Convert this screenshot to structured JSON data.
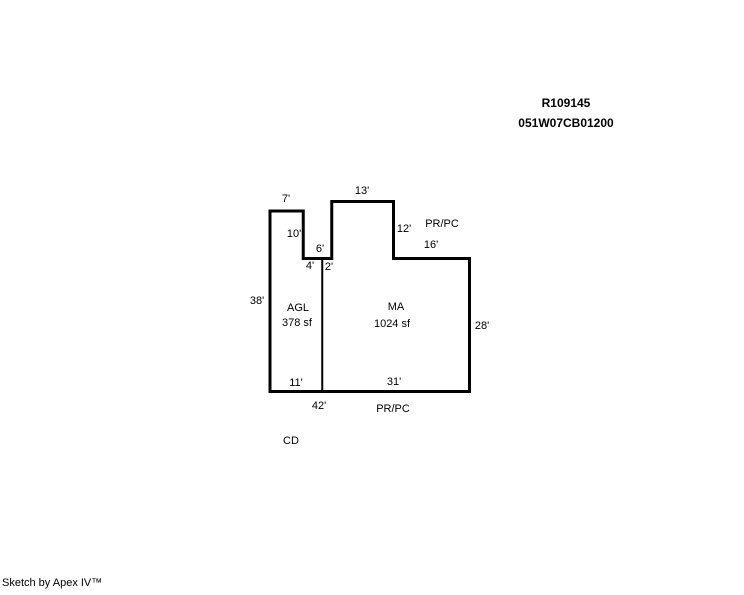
{
  "page": {
    "background": "#ffffff",
    "text_color": "#000000"
  },
  "header": {
    "account_id": "R109145",
    "map_taxlot": "051W07CB01200"
  },
  "sketch": {
    "line_color": "#000000",
    "outline_stroke_px": 3,
    "divider_stroke_px": 2,
    "px_per_ft": 4.75,
    "origin_px": {
      "x": 270,
      "y": 211
    },
    "outline_ft": [
      [
        0,
        0
      ],
      [
        7,
        0
      ],
      [
        7,
        10
      ],
      [
        13,
        10
      ],
      [
        13,
        -2
      ],
      [
        26,
        -2
      ],
      [
        26,
        10
      ],
      [
        42,
        10
      ],
      [
        42,
        38
      ],
      [
        0,
        38
      ]
    ],
    "divider_ft": [
      [
        11,
        10
      ],
      [
        11,
        38
      ]
    ],
    "areas": [
      {
        "code": "AGL",
        "size": "378 sf"
      },
      {
        "code": "MA",
        "size": "1024 sf"
      }
    ],
    "labels": [
      {
        "text": "7'",
        "kind": "dimension",
        "x": 286,
        "y": 199
      },
      {
        "text": "13'",
        "kind": "dimension",
        "x": 362,
        "y": 191
      },
      {
        "text": "10'",
        "kind": "dimension",
        "x": 294,
        "y": 234
      },
      {
        "text": "6'",
        "kind": "dimension",
        "x": 320,
        "y": 249
      },
      {
        "text": "4'",
        "kind": "dimension",
        "x": 310,
        "y": 266
      },
      {
        "text": "2'",
        "kind": "dimension",
        "x": 329,
        "y": 267
      },
      {
        "text": "12'",
        "kind": "dimension",
        "x": 404,
        "y": 229
      },
      {
        "text": "PR/PC",
        "kind": "annotation",
        "x": 442,
        "y": 224
      },
      {
        "text": "16'",
        "kind": "dimension",
        "x": 431,
        "y": 245
      },
      {
        "text": "38'",
        "kind": "dimension",
        "x": 257,
        "y": 301
      },
      {
        "text": "AGL",
        "kind": "area-code",
        "x": 298,
        "y": 308
      },
      {
        "text": "378 sf",
        "kind": "area-size",
        "x": 297,
        "y": 323
      },
      {
        "text": "MA",
        "kind": "area-code",
        "x": 396,
        "y": 307
      },
      {
        "text": "1024 sf",
        "kind": "area-size",
        "x": 392,
        "y": 324
      },
      {
        "text": "28'",
        "kind": "dimension",
        "x": 482,
        "y": 326
      },
      {
        "text": "11'",
        "kind": "dimension",
        "x": 296,
        "y": 383
      },
      {
        "text": "31'",
        "kind": "dimension",
        "x": 394,
        "y": 382
      },
      {
        "text": "42'",
        "kind": "dimension",
        "x": 319,
        "y": 406
      },
      {
        "text": "PR/PC",
        "kind": "annotation",
        "x": 393,
        "y": 409
      },
      {
        "text": "CD",
        "kind": "annotation",
        "x": 291,
        "y": 441
      }
    ]
  },
  "footer": {
    "credit": "Sketch by Apex IV™"
  }
}
